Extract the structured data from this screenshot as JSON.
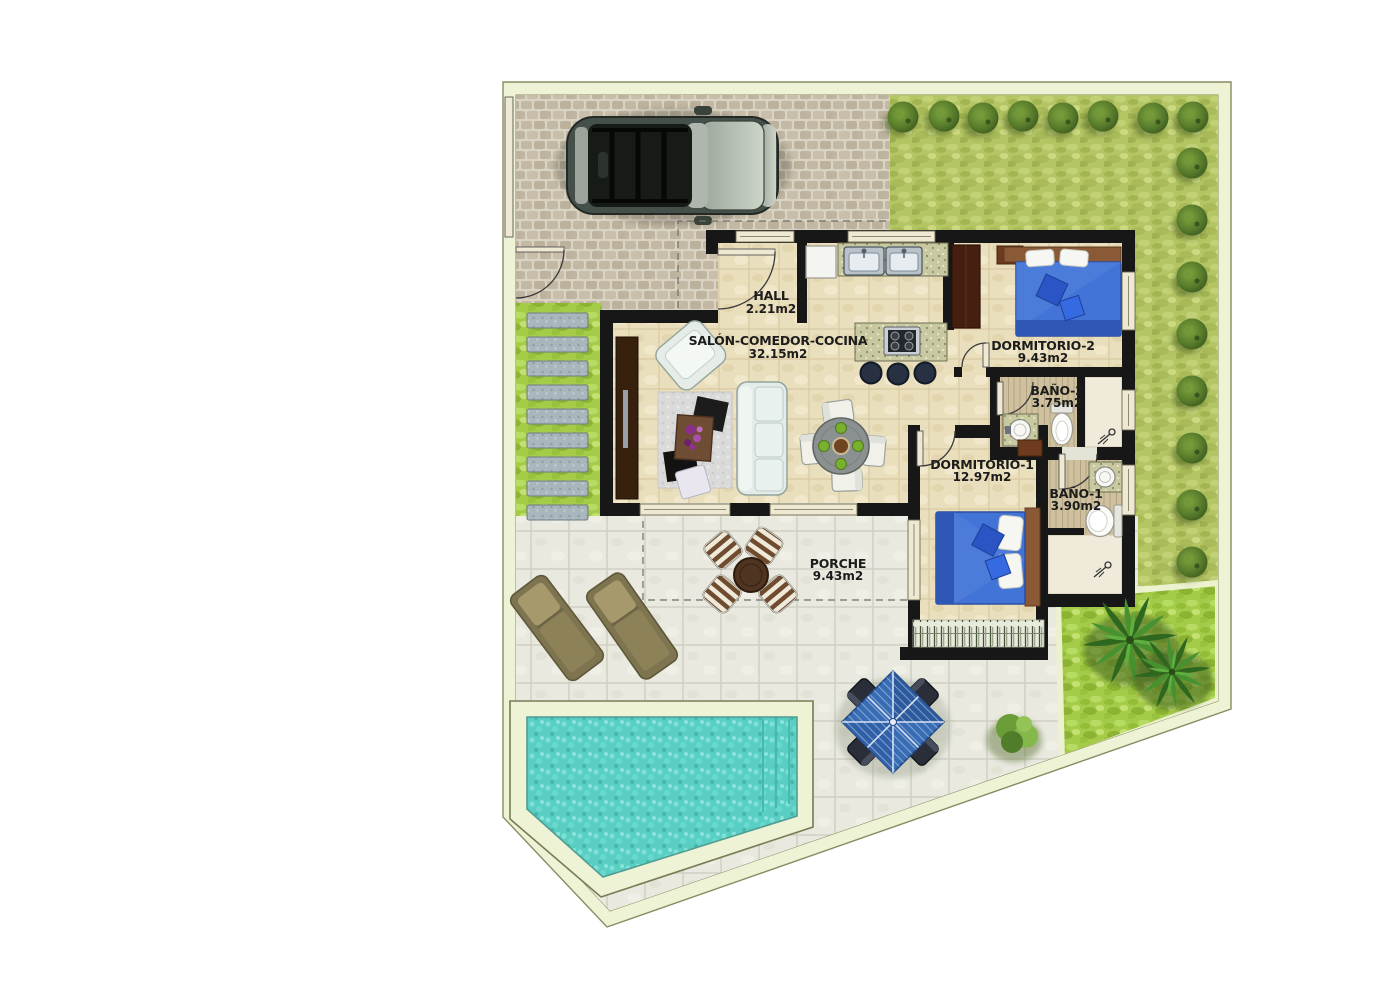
{
  "plan_type": "floor-plan",
  "rooms": [
    {
      "name": "HALL",
      "area": "2.21m2"
    },
    {
      "name": "SALÓN-COMEDOR-COCINA",
      "area": "32.15m2"
    },
    {
      "name": "DORMITORIO-2",
      "area": "9.43m2"
    },
    {
      "name": "BAÑO-2",
      "area": "3.75m2"
    },
    {
      "name": "DORMITORIO-1",
      "area": "12.97m2"
    },
    {
      "name": "BAÑO-1",
      "area": "3.90m2"
    },
    {
      "name": "PORCHE",
      "area": "9.43m2"
    }
  ],
  "features": [
    "car",
    "driveway",
    "lawn",
    "hedge-shrubs",
    "stepping-stones",
    "swimming-pool",
    "sun-loungers",
    "porch-table-chairs",
    "parasol-dining-set",
    "palm-trees",
    "garden-bush",
    "kitchen-island",
    "double-beds",
    "bathrooms"
  ],
  "colors": {
    "wall": "#171717",
    "plot_band": "#eef3d6",
    "driveway": "#d8d2c2",
    "lawn": "#b4c564",
    "bright_lawn": "#a5cc49",
    "terrace": "#e9e9e0",
    "floor": "#eadfbd",
    "wood": "#cfc1a0",
    "water": "#59cfc4",
    "bed_blue": "#4273d6",
    "window": "#efe8d2"
  }
}
